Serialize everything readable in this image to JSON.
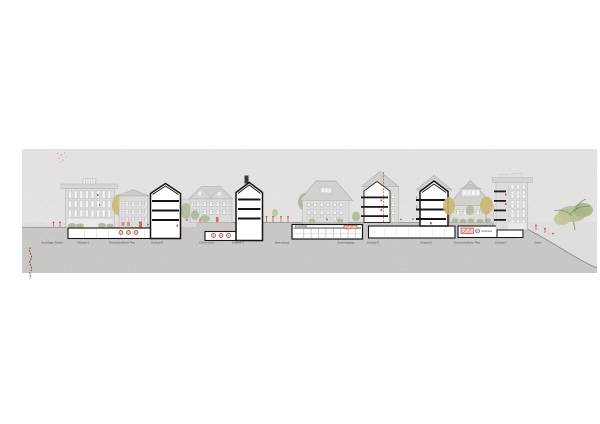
{
  "drawing": {
    "type": "architectural street elevation / section",
    "ground_labels": [
      "Ernst-Egger-Strasse",
      "Gebäude A",
      "Gemeinschaftlicher Platz",
      "Gebäude B",
      "Grüner Garten",
      "Gebäude C",
      "Seitenstrasse",
      "Quartiersgarage",
      "Gebäude D",
      "Gebäude E",
      "Gemeinschaftlicher Platz",
      "Gebäude F",
      "Garten"
    ],
    "annotations": {
      "garage": "Einstellhalle",
      "connection": "Anschluss"
    },
    "colors": {
      "paper": "#ffffff",
      "sky_band": "#e6e5e3",
      "terrain": "#cdccca",
      "section_black": "#151515",
      "accent_red": "#b03a2e",
      "foliage_green": "#a9b694",
      "foliage_yellow": "#c9b76d",
      "wall_gray": "#dddcda",
      "roof_gray": "#d0cfcd",
      "label_gray": "#55534f"
    }
  }
}
